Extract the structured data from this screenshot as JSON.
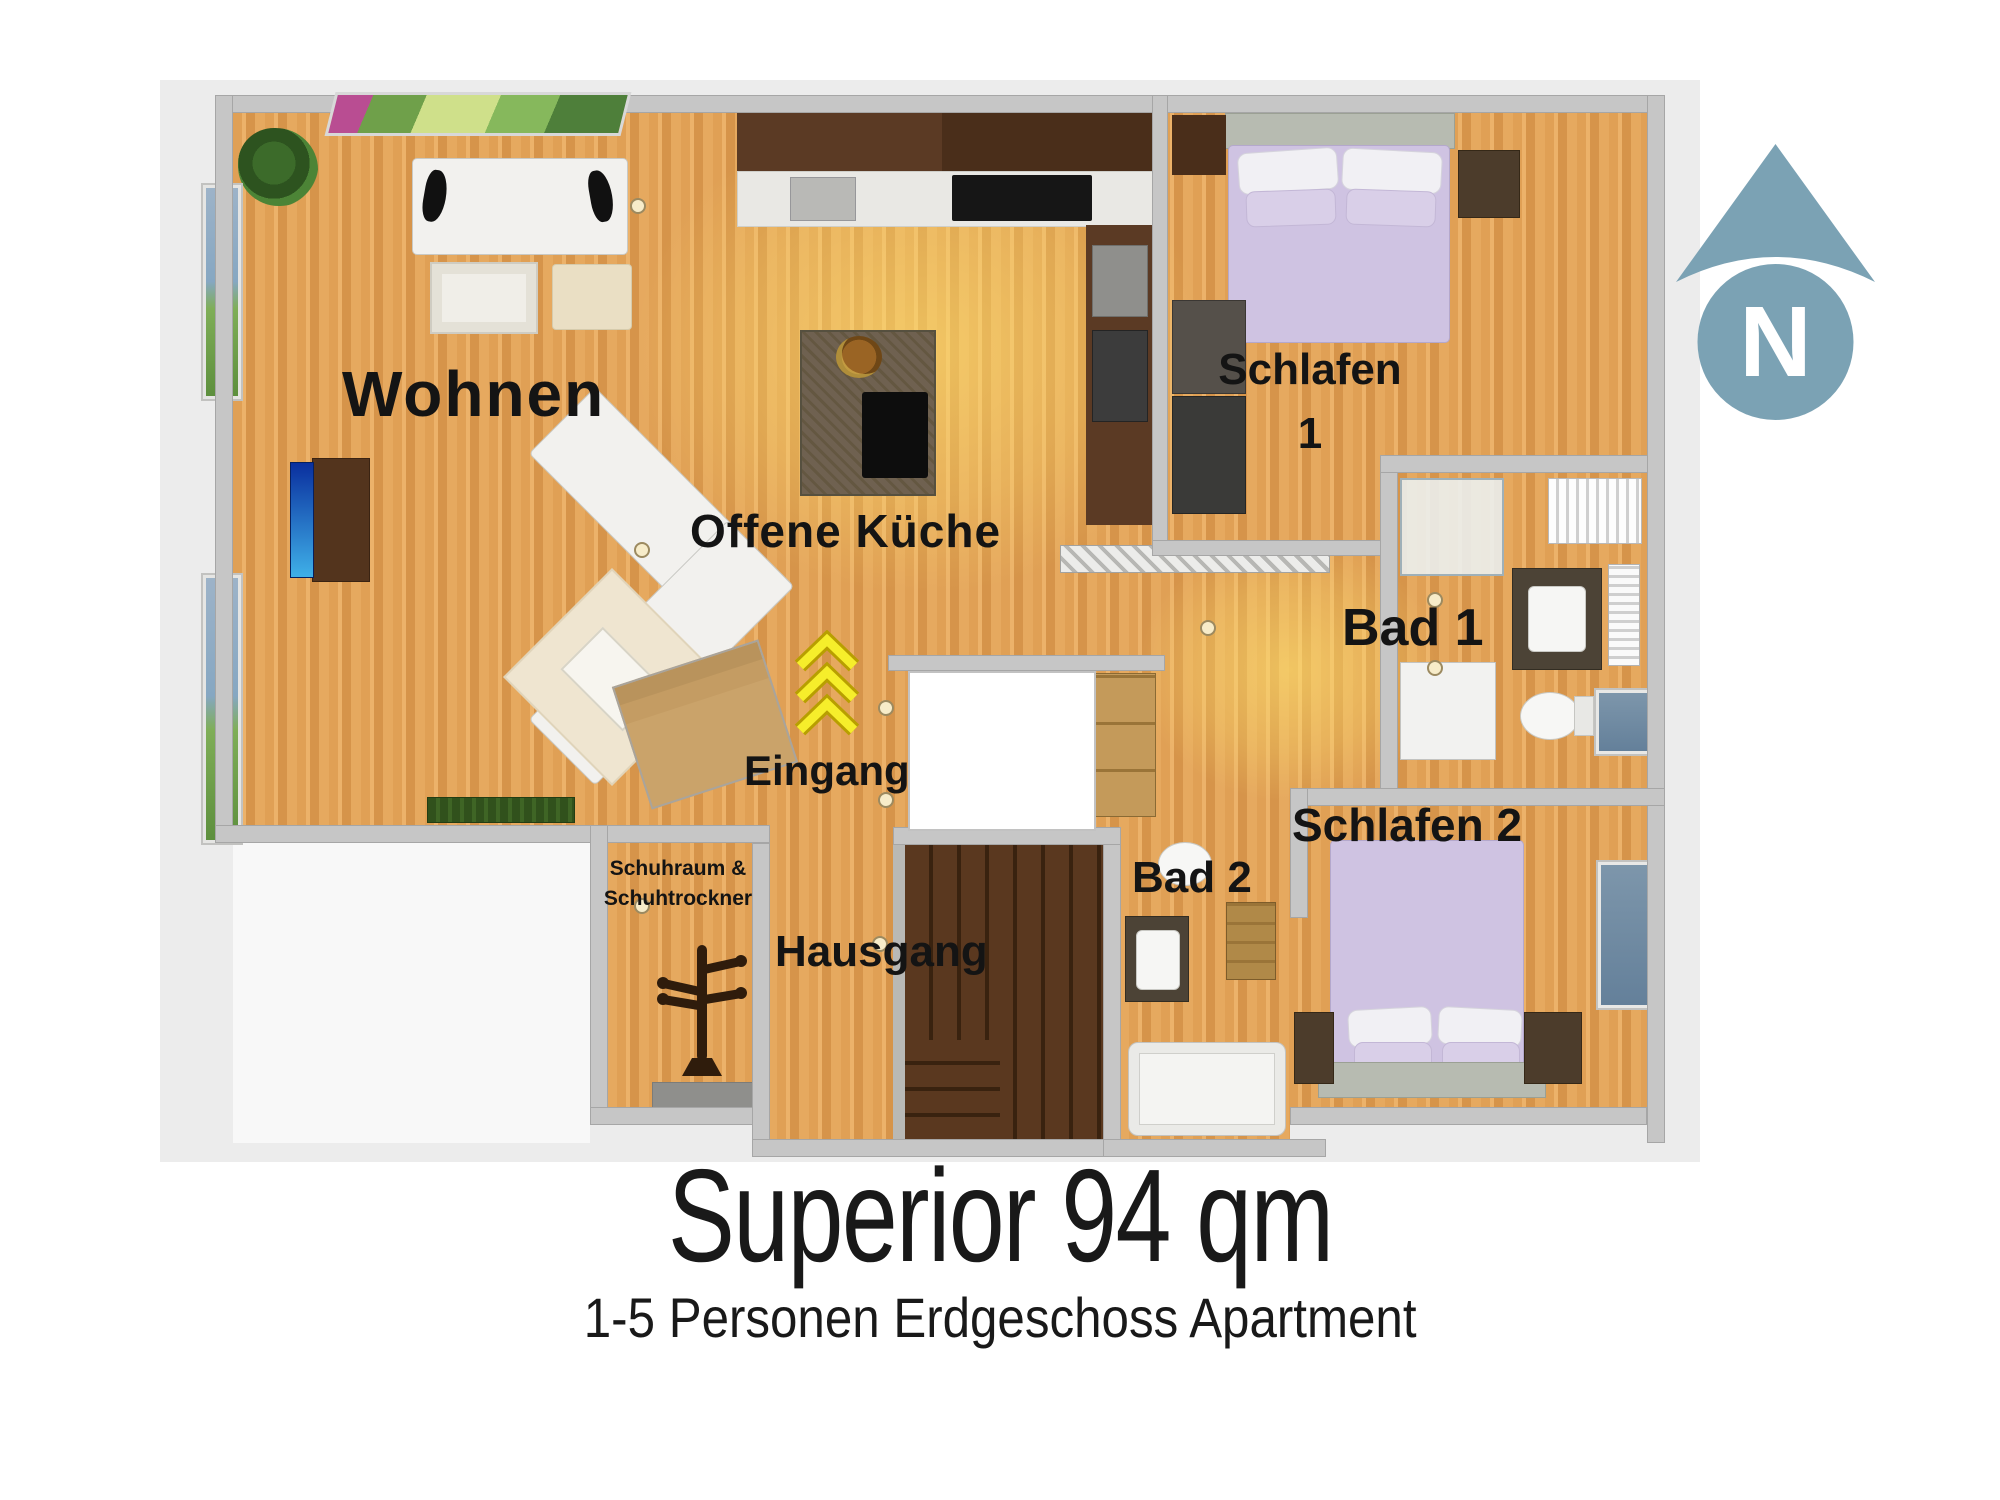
{
  "floor_plan": {
    "rooms": {
      "wohnen": {
        "label": "Wohnen"
      },
      "offene_kueche": {
        "label": "Offene Küche"
      },
      "schlafen_1": {
        "label_line1": "Schlafen",
        "label_line2": "1"
      },
      "bad_1": {
        "label": "Bad 1"
      },
      "schlafen_2": {
        "label": "Schlafen 2"
      },
      "bad_2": {
        "label": "Bad 2"
      },
      "eingang": {
        "label": "Eingang"
      },
      "hausgang": {
        "label": "Hausgang"
      },
      "schuhraum": {
        "label_line1": "Schuhraum &",
        "label_line2": "Schuhtrockner"
      }
    },
    "compass": {
      "letter": "N"
    },
    "icons": {
      "compass": "north-arrow-icon",
      "entrance_arrows": "up-chevrons-icon",
      "coat_rack": "coat-rack-icon"
    },
    "colors": {
      "compass_blue": "#7ba2b4",
      "floor_wood": "#e2a158",
      "wall_gray": "#c6c6c6",
      "stairs_brown": "#54341e",
      "bed_lavender": "#cfc3e2",
      "arrow_yellow": "#f6ee2b",
      "label_black": "#141414"
    }
  },
  "footer": {
    "title": "Superior 94 qm",
    "subtitle": "1-5 Personen Erdgeschoss Apartment"
  }
}
